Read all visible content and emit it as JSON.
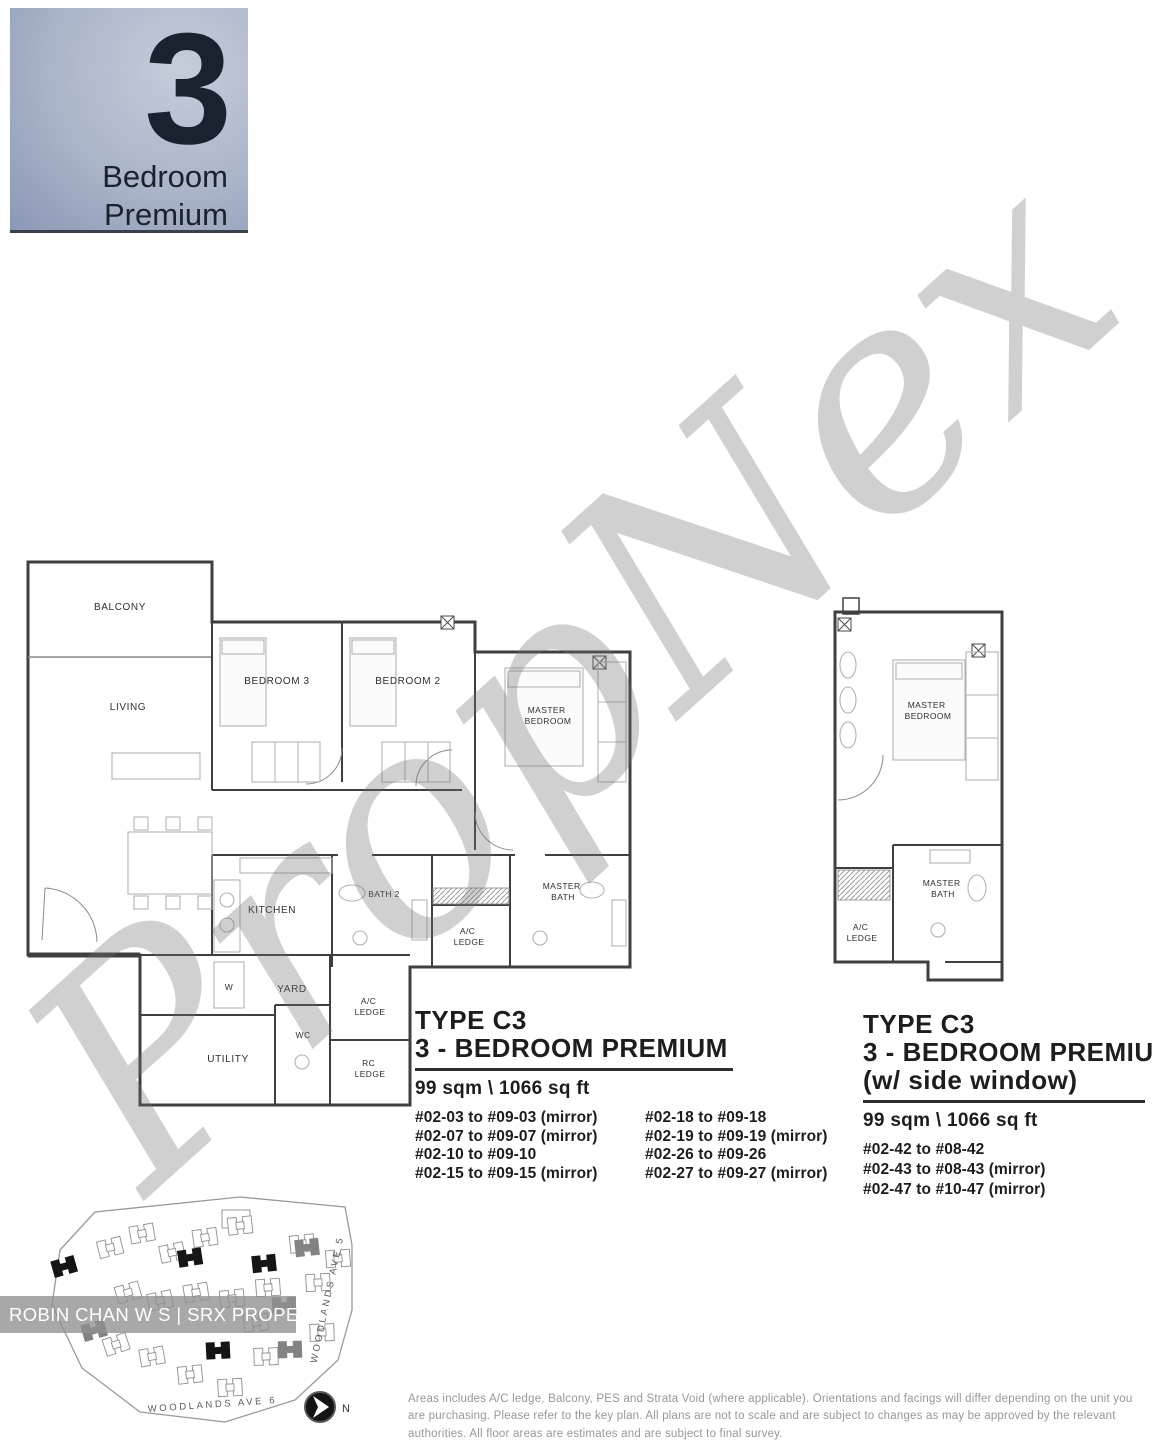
{
  "colors": {
    "badge_from": "#c6cdda",
    "badge_mid": "#a9b3c9",
    "badge_to": "#8b98b6",
    "wall": "#3f3f3f",
    "wm": "rgba(112,112,112,0.33)"
  },
  "badge": {
    "number": "3",
    "line1": "Bedroom",
    "line2": "Premium"
  },
  "watermark": {
    "text": "PropNex"
  },
  "plan_left": {
    "labels": {
      "balcony": "BALCONY",
      "living": "LIVING",
      "bedroom3": "BEDROOM 3",
      "bedroom2": "BEDROOM 2",
      "master": "MASTER",
      "bedroom_word": "BEDROOM",
      "kitchen": "KITCHEN",
      "bath2": "BATH 2",
      "bath_word": "BATH",
      "yard": "YARD",
      "washer": "W",
      "wc": "WC",
      "utility": "UTILITY",
      "ac": "A/C",
      "rc": "RC",
      "ledge": "LEDGE"
    }
  },
  "plan_right": {
    "labels": {
      "master": "MASTER",
      "bedroom_word": "BEDROOM",
      "bath_word": "BATH",
      "ac": "A/C",
      "ledge": "LEDGE"
    }
  },
  "type_left": {
    "title1": "TYPE C3",
    "title2": "3 - BEDROOM PREMIUM",
    "area": "99 sqm \\ 1066 sq ft",
    "units_col1": [
      "#02-03 to #09-03 (mirror)",
      "#02-07 to #09-07 (mirror)",
      "#02-10 to #09-10",
      "#02-15 to #09-15 (mirror)"
    ],
    "units_col2": [
      "#02-18 to #09-18",
      "#02-19 to #09-19 (mirror)",
      "#02-26 to #09-26",
      "#02-27 to #09-27 (mirror)"
    ]
  },
  "type_right": {
    "title1": "TYPE C3",
    "title2": "3 - BEDROOM PREMIUM",
    "title3": "(w/ side window)",
    "area": "99 sqm \\ 1066 sq ft",
    "units": [
      "#02-42 to #08-42",
      "#02-43 to #08-43 (mirror)",
      "#02-47 to #10-47 (mirror)"
    ]
  },
  "siteplan": {
    "road_bottom": "WOODLANDS AVE 6",
    "road_right": "WOODLANDS AVE 5",
    "north": "N"
  },
  "overlay_bar": {
    "text": "ROBIN CHAN W S | SRX PROPERTY"
  },
  "disclaimer": "Areas includes A/C ledge, Balcony, PES and Strata Void (where applicable). Orientations and facings will differ depending on the unit you are purchasing. Please refer to the key plan. All plans are not to scale and are subject to changes as may be approved by the relevant authorities. All floor areas are estimates and are subject to final survey."
}
